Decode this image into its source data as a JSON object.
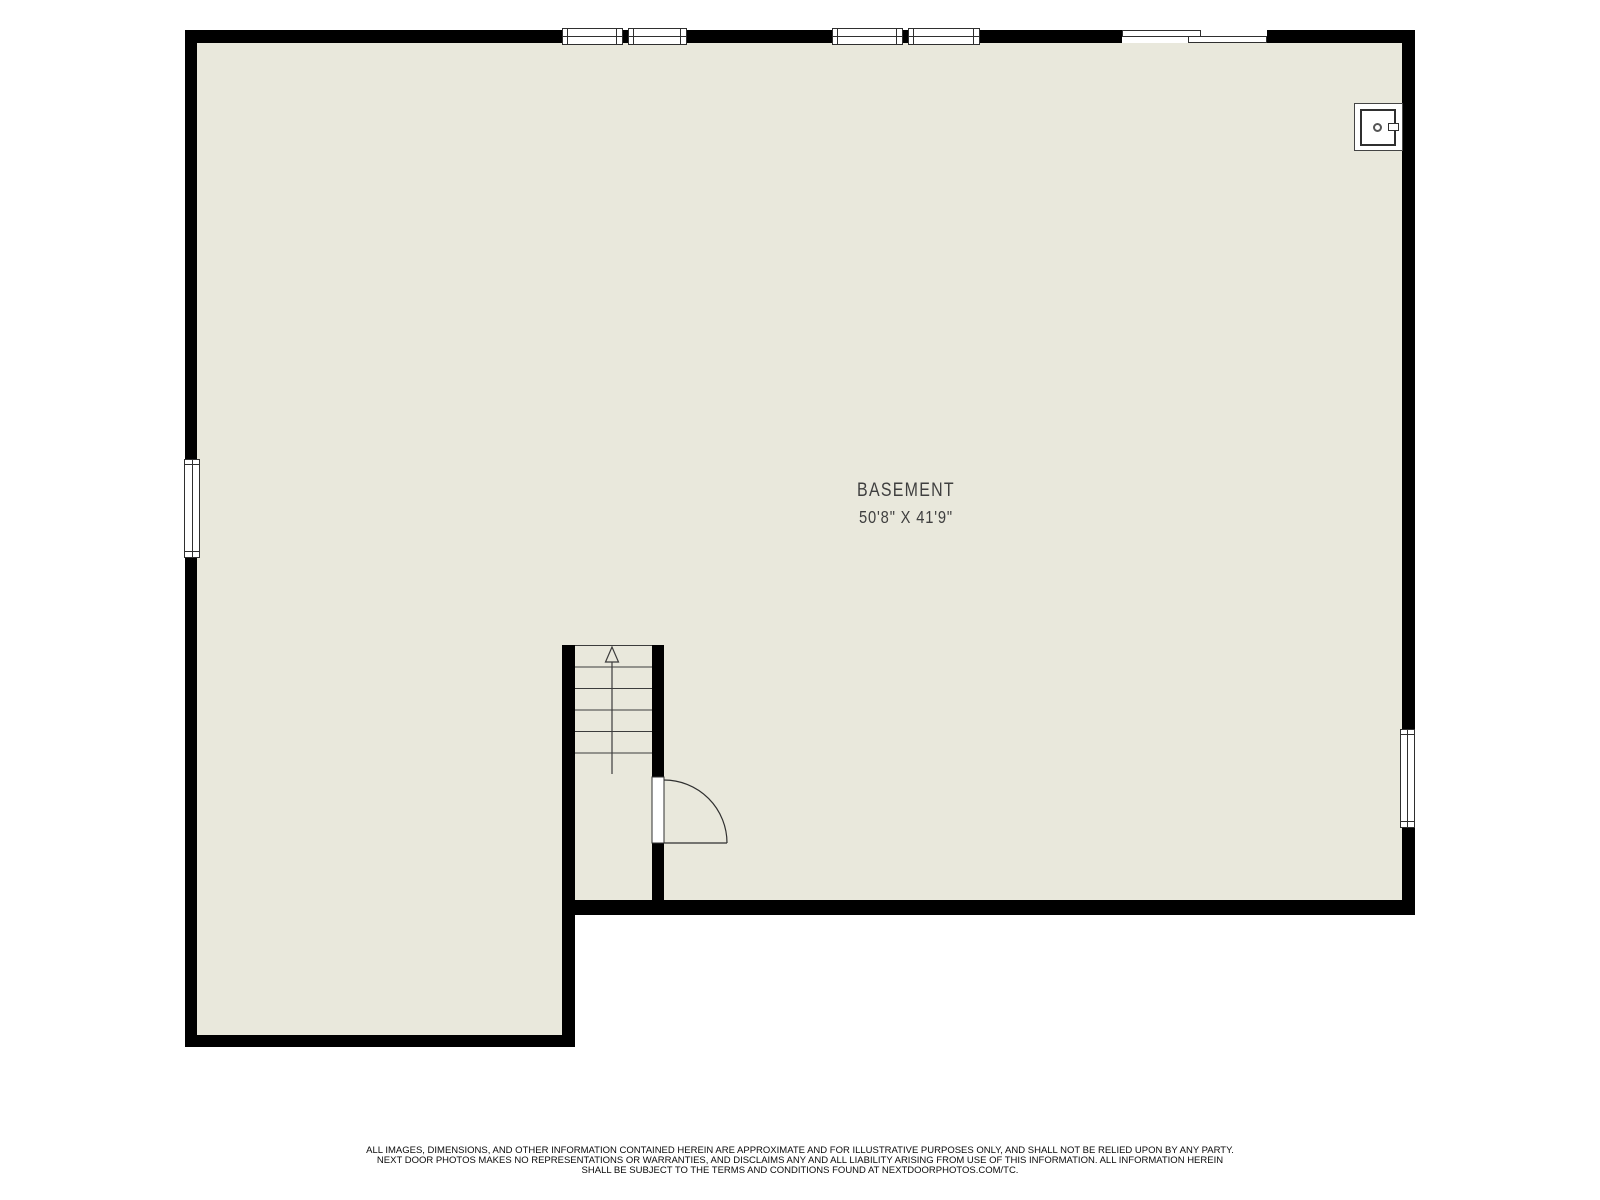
{
  "floorplan": {
    "room": {
      "name": "BASEMENT",
      "dimensions": "50'8\" X 41'9\""
    },
    "features": {
      "stairs": {
        "treads": 6,
        "direction": "up"
      },
      "windows": [
        "top-wall-double-window-left",
        "top-wall-double-window-middle",
        "left-wall-window",
        "right-wall-window"
      ],
      "doors": [
        "top-wall-sliding-door",
        "stairwell-swing-door"
      ],
      "fixture": "utility-appliance"
    },
    "colors": {
      "wall": "#000000",
      "floor": "#e9e8dc",
      "line": "#2f2f2f",
      "background": "#ffffff"
    }
  },
  "disclaimer": {
    "line1": "ALL IMAGES, DIMENSIONS, AND OTHER INFORMATION CONTAINED HEREIN ARE APPROXIMATE AND FOR ILLUSTRATIVE PURPOSES ONLY, AND SHALL NOT BE RELIED UPON BY ANY PARTY.",
    "line2": "NEXT DOOR PHOTOS MAKES NO REPRESENTATIONS OR WARRANTIES, AND DISCLAIMS ANY AND ALL LIABILITY ARISING FROM USE OF THIS INFORMATION. ALL INFORMATION HEREIN",
    "line3": "SHALL BE SUBJECT TO THE TERMS AND CONDITIONS FOUND AT NEXTDOORPHOTOS.COM/TC."
  }
}
